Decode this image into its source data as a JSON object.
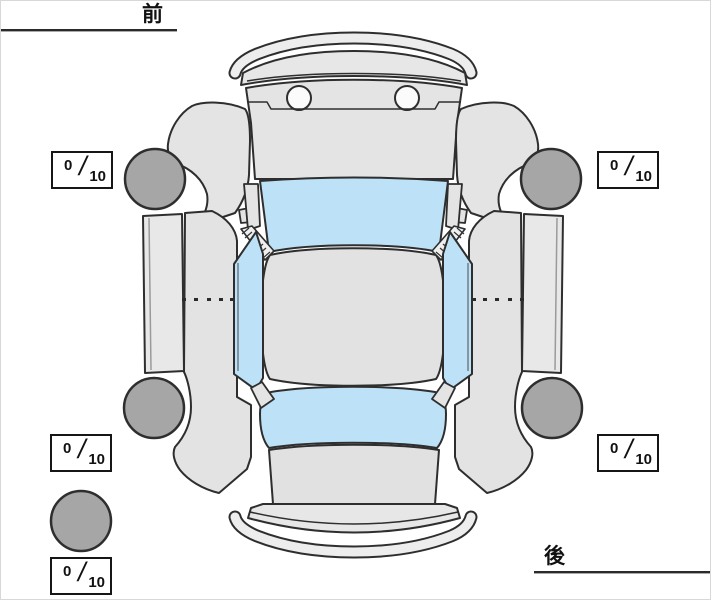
{
  "orientation": {
    "front_label": "前",
    "rear_label": "後"
  },
  "ratings": {
    "separator": "/",
    "front_left": {
      "value": "0",
      "max": "10"
    },
    "front_right": {
      "value": "0",
      "max": "10"
    },
    "rear_left": {
      "value": "0",
      "max": "10"
    },
    "rear_right": {
      "value": "0",
      "max": "10"
    },
    "spare": {
      "value": "0",
      "max": "10"
    }
  },
  "diagram": {
    "type": "car-top-view",
    "body_color": "#e4e4e4",
    "window_color": "#bde2f8",
    "tire_color": "#a6a6a6",
    "outline_color": "#2e2e2e",
    "tires": [
      "front-left",
      "front-right",
      "rear-left",
      "rear-right",
      "spare"
    ]
  }
}
